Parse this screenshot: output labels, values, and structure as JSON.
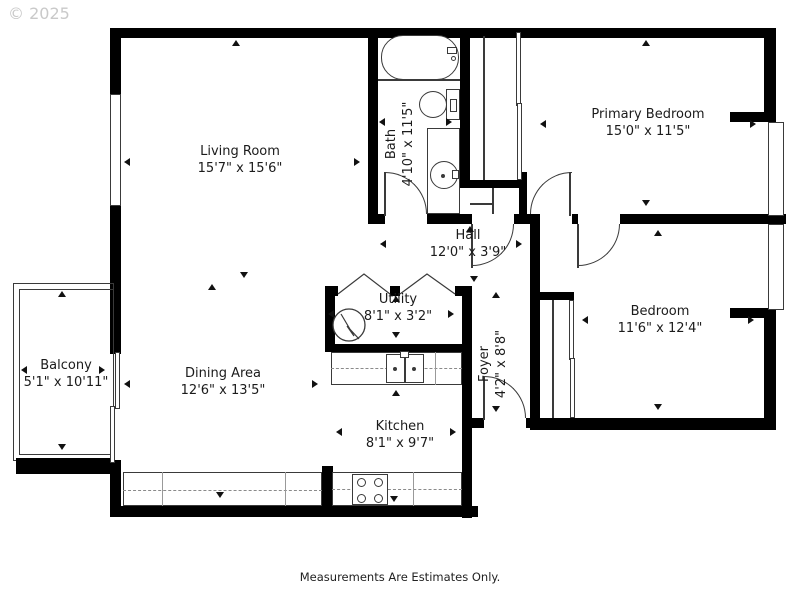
{
  "watermark": "© 2025",
  "footer": "Measurements Are Estimates Only.",
  "rooms": {
    "living": {
      "name": "Living Room",
      "dims": "15'7\" x 15'6\""
    },
    "bath": {
      "name": "Bath",
      "dims": "4'10\" x 11'5\""
    },
    "primary": {
      "name": "Primary Bedroom",
      "dims": "15'0\" x 11'5\""
    },
    "hall": {
      "name": "Hall",
      "dims": "12'0\" x 3'9\""
    },
    "utility": {
      "name": "Utility",
      "dims": "8'1\" x 3'2\""
    },
    "bedroom": {
      "name": "Bedroom",
      "dims": "11'6\" x 12'4\""
    },
    "balcony": {
      "name": "Balcony",
      "dims": "5'1\" x 10'11\""
    },
    "dining": {
      "name": "Dining Area",
      "dims": "12'6\" x 13'5\""
    },
    "foyer": {
      "name": "Foyer",
      "dims": "4'2\" x 8'8\""
    },
    "kitchen": {
      "name": "Kitchen",
      "dims": "8'1\" x 9'7\""
    }
  },
  "colors": {
    "wall": "#000000",
    "line": "#3a3a3a",
    "text": "#1b1b1b",
    "watermark": "#c9c9c9"
  }
}
